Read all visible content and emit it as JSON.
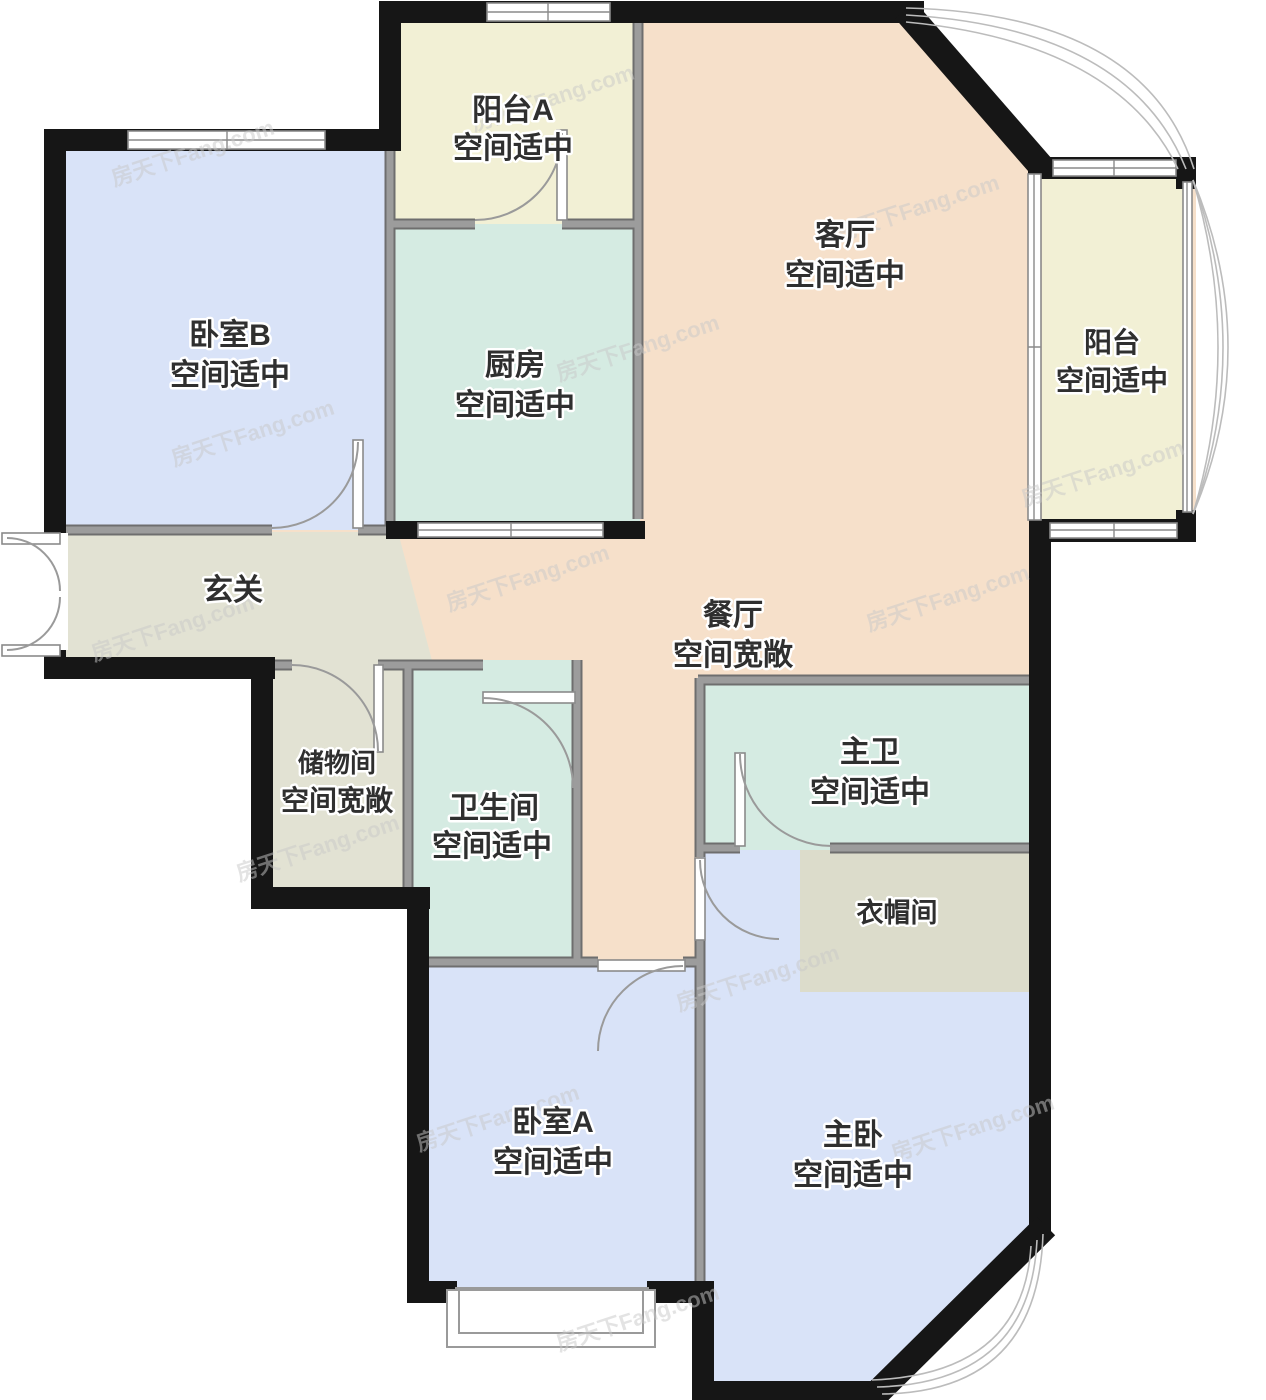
{
  "floorplan": {
    "watermark": "房天下Fang.com",
    "palette": {
      "outer_wall": "#161616",
      "inner_wall_edge": "#6e6e6e",
      "inner_wall_core": "#9c9c9c",
      "living_dining": "#f6e0ca",
      "bedroom": "#d9e3f8",
      "wet_room": "#d5ebe2",
      "balcony": "#f2f0d5",
      "hall_storage": "#e2e2d3",
      "cloakroom": "#dcdccb"
    },
    "rooms": {
      "balconyA": {
        "name": "阳台A",
        "note": "空间适中",
        "color": "#f2f0d5"
      },
      "living": {
        "name": "客厅",
        "note": "空间适中",
        "color": "#f6e0ca"
      },
      "bedroomB": {
        "name": "卧室B",
        "note": "空间适中",
        "color": "#d9e3f8"
      },
      "kitchen": {
        "name": "厨房",
        "note": "空间适中",
        "color": "#d5ebe2"
      },
      "balcony": {
        "name": "阳台",
        "note": "空间适中",
        "color": "#f2f0d5"
      },
      "hallway": {
        "name": "玄关",
        "color": "#e2e2d3"
      },
      "dining": {
        "name": "餐厅",
        "note": "空间宽敞",
        "color": "#f6e0ca"
      },
      "storage": {
        "name": "储物间",
        "note": "空间宽敞",
        "color": "#e2e2d3"
      },
      "bathroom": {
        "name": "卫生间",
        "note": "空间适中",
        "color": "#d5ebe2"
      },
      "masterBath": {
        "name": "主卫",
        "note": "空间适中",
        "color": "#d5ebe2"
      },
      "cloakroom": {
        "name": "衣帽间",
        "color": "#dcdccb"
      },
      "bedroomA": {
        "name": "卧室A",
        "note": "空间适中",
        "color": "#d9e3f8"
      },
      "master": {
        "name": "主卧",
        "note": "空间适中",
        "color": "#d9e3f8"
      }
    }
  }
}
